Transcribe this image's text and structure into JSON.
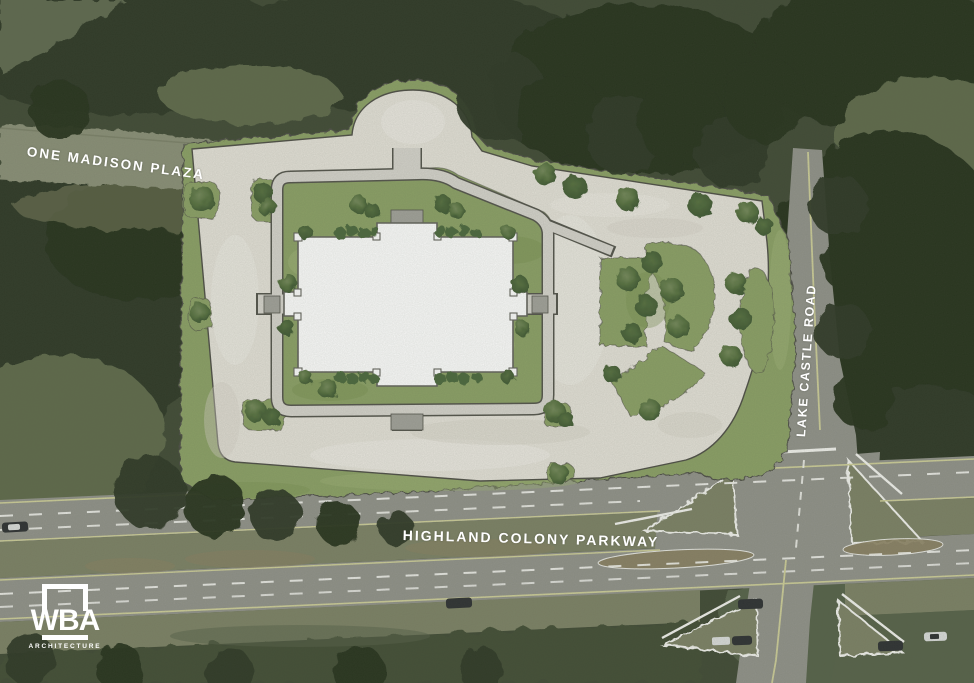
{
  "page": {
    "title": "Architectural site plan over aerial photograph"
  },
  "labels": {
    "road_top_left": "ONE MADISON PLAZA",
    "road_right": "LAKE CASTLE ROAD",
    "road_bottom": "HIGHLAND COLONY PARKWAY"
  },
  "logo": {
    "acronym": "WBA",
    "subtitle": "ARCHITECTURE"
  },
  "colors": {
    "forest_base": "#404a35",
    "forest_dark": "#2e3827",
    "forest_darker": "#26301f",
    "forest_light": "#5f6b4c",
    "clearing": "#6f7a5e",
    "aerial_road": "#8b9078",
    "dirt": "#6f7557",
    "asphalt": "#92938b",
    "median_grass": "#7d8266",
    "median_brown": "#8b8162",
    "field": "#57624a",
    "hedge": "#434e36",
    "parking": "#e6e3da",
    "parking_light": "#f2f0e9",
    "parking_shade": "#d6d2c7",
    "lawn": "#8ca166",
    "lawn_light": "#9fb378",
    "lawn_dark": "#78904f",
    "bush": "#4c673d",
    "tree_light": "#74895a",
    "tree_mid": "#56703f",
    "tree_dark": "#3c5531",
    "path": "#d7d5ce",
    "path_edge": "#54544c",
    "steps": "#a2a29b",
    "building": "#ffffff",
    "building_edge": "#63635c",
    "plan_edge": "#4e4e46",
    "lane_white": "#f4f4f0",
    "lane_yellow": "#cfcf9a",
    "car_dark": "#2d3032",
    "car_white": "#dcdedd",
    "label": "#ffffff"
  }
}
